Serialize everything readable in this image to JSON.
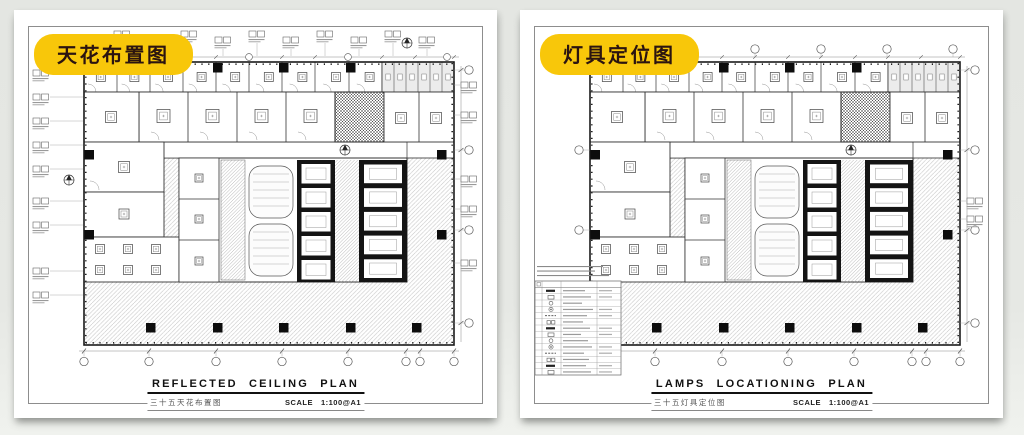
{
  "page": {
    "background_top": "#e4e6e2",
    "background_bottom": "#f0f2ee"
  },
  "colors": {
    "badge_bg": "#f8c70a",
    "badge_text": "#2b1410",
    "paper": "#ffffff",
    "drawing_line": "#1a1a1a",
    "hatch_light": "#bdbdbd"
  },
  "panels": [
    {
      "badge": "天花布置图",
      "title": "REFLECTED CEILING PLAN",
      "subtitle_cn": "三十五天花布置图",
      "scale_label": "SCALE",
      "scale_value": "1:100@A1"
    },
    {
      "badge": "灯具定位图",
      "title": "LAMPS LOCATIONING PLAN",
      "subtitle_cn": "三十五灯具定位图",
      "scale_label": "SCALE",
      "scale_value": "1:100@A1"
    }
  ]
}
